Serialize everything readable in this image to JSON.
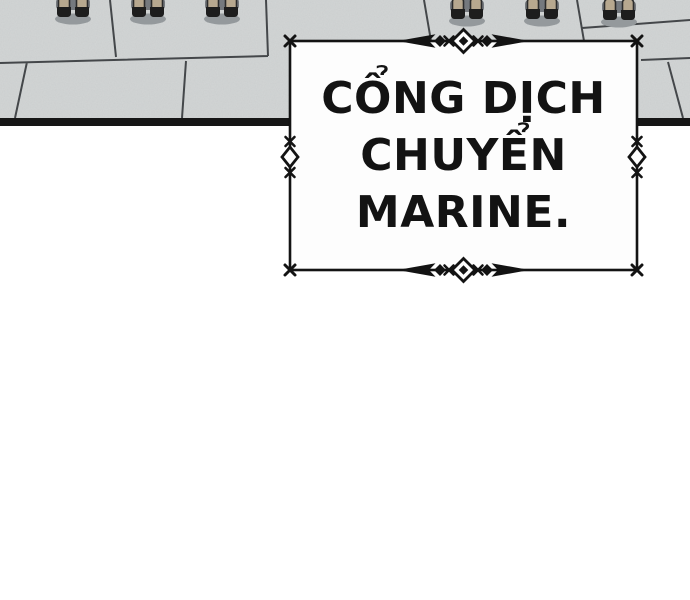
{
  "caption_box": {
    "lines": [
      "CỔNG DỊCH",
      "CHUYỂN",
      "MARINE."
    ],
    "full_text": "CỔNG DỊCH CHUYỂN MARINE."
  },
  "ornaments": {
    "corner": "x-mark",
    "sides": "diamond-with-x-marks",
    "top_bottom": "arrow-diamond-divider"
  },
  "platform": {
    "feet_pairs": [
      {
        "x": 73,
        "dy": 0
      },
      {
        "x": 148,
        "dy": 0
      },
      {
        "x": 222,
        "dy": 0
      },
      {
        "x": 467,
        "dy": 2
      },
      {
        "x": 542,
        "dy": 2
      },
      {
        "x": 619,
        "dy": 3
      }
    ]
  },
  "colors": {
    "stone": "#d3d6d6",
    "mortar": "#44474a",
    "edge": "#161616",
    "ink": "#131313",
    "box_bg": "#fdfdfd",
    "skin": "#b7a88f",
    "boot": "#1d1d1d",
    "back_shadow": "#75797e",
    "ground_shadow": "#94999c"
  }
}
